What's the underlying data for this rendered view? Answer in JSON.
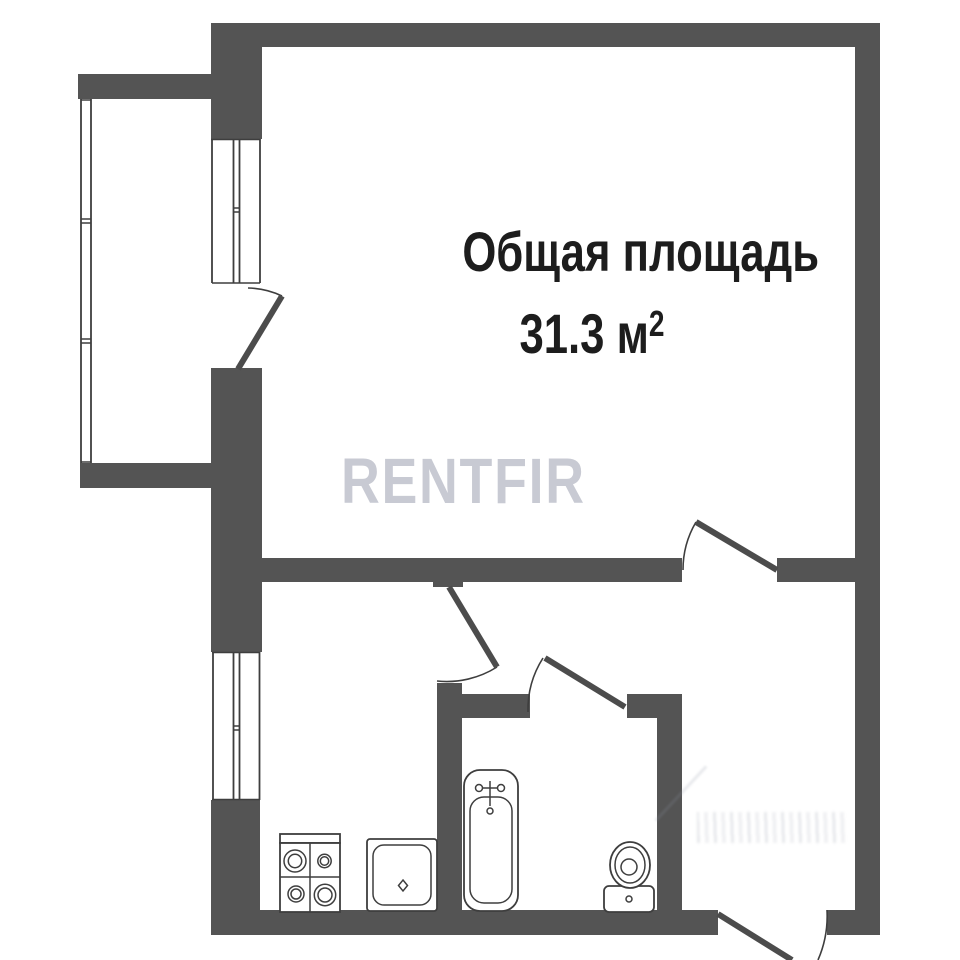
{
  "title": {
    "line1": "Общая площадь",
    "area_value": "31.3",
    "area_unit": " м",
    "area_sup": "2"
  },
  "watermark": {
    "text": "RENTFIR"
  },
  "colors": {
    "wall": "#545454",
    "line": "#3e3e3e",
    "door": "#4c4c4c",
    "background": "#ffffff",
    "watermark": "#c8cad3",
    "text": "#1d1d1d",
    "faint": "#8e94a4"
  },
  "fixtures": [
    "stove-icon",
    "sink-icon",
    "bathtub-icon",
    "toilet-icon"
  ]
}
